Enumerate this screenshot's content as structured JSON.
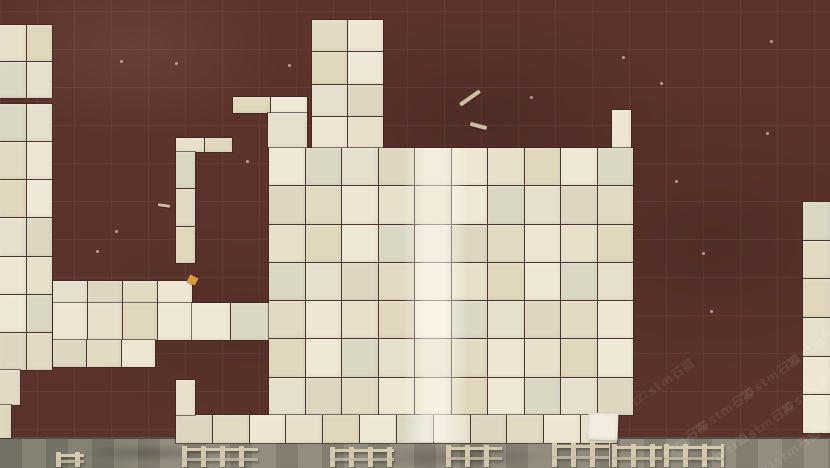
{
  "scene": {
    "description": "Top-down photo: cream marble tiles dry-laid in an irregular tetris-like pattern on a dark maroon screed floor; gray concrete walkway with small metal trestle stands along the bottom edge; diagonal watermarks in lower right",
    "colors": {
      "floor_maroon": "#5c332c",
      "tile_cream": "#e8e0cb",
      "tile_joint": "#4b372a",
      "concrete_gray": "#8d8779",
      "stand_metal": "#d8cfb5",
      "watermark": "#ffffff"
    },
    "watermark": {
      "text": "stm石猫",
      "opacity": 0.27,
      "angle_deg": -35,
      "positions": [
        [
          648,
          456
        ],
        [
          694,
          423
        ],
        [
          740,
          390
        ],
        [
          786,
          357
        ],
        [
          824,
          326
        ],
        [
          688,
          468
        ],
        [
          734,
          437
        ],
        [
          780,
          404
        ],
        [
          822,
          372
        ],
        [
          760,
          464
        ],
        [
          806,
          433
        ],
        [
          634,
          394
        ]
      ]
    },
    "tile_palette": [
      "#e8e0cb",
      "#eee6d2",
      "#e3dac4",
      "#ded6c0",
      "#e6dfcd",
      "#dbd7c5",
      "#efe8d6",
      "#e1d7bd"
    ],
    "tile_regions": [
      {
        "id": "left-top-block",
        "x": 0,
        "y": 25,
        "w": 52,
        "h": 73,
        "cols": 2,
        "rows": 2
      },
      {
        "id": "left-strip",
        "x": 0,
        "y": 104,
        "w": 52,
        "h": 266,
        "cols": 2,
        "rows": 7
      },
      {
        "id": "left-strip-step",
        "x": 0,
        "y": 370,
        "w": 20,
        "h": 35,
        "cols": 1,
        "rows": 1
      },
      {
        "id": "left-strip-foot",
        "x": 0,
        "y": 405,
        "w": 11,
        "h": 33,
        "cols": 1,
        "rows": 1
      },
      {
        "id": "mid-block-top",
        "x": 53,
        "y": 281,
        "w": 139,
        "h": 22,
        "cols": 4,
        "rows": 1
      },
      {
        "id": "mid-block-mid",
        "x": 53,
        "y": 303,
        "w": 139,
        "h": 37,
        "cols": 4,
        "rows": 1
      },
      {
        "id": "mid-block-ext",
        "x": 192,
        "y": 303,
        "w": 77,
        "h": 37,
        "cols": 2,
        "rows": 1
      },
      {
        "id": "mid-block-bottom",
        "x": 53,
        "y": 340,
        "w": 102,
        "h": 27,
        "cols": 3,
        "rows": 1
      },
      {
        "id": "hook-cap",
        "x": 176,
        "y": 138,
        "w": 56,
        "h": 14,
        "cols": 2,
        "rows": 1
      },
      {
        "id": "hook-stem",
        "x": 176,
        "y": 152,
        "w": 19,
        "h": 111,
        "cols": 1,
        "rows": 3
      },
      {
        "id": "top-column",
        "x": 312,
        "y": 20,
        "w": 71,
        "h": 128,
        "cols": 2,
        "rows": 4
      },
      {
        "id": "top-ledge",
        "x": 233,
        "y": 97,
        "w": 74,
        "h": 16,
        "cols": 2,
        "rows": 1
      },
      {
        "id": "top-ledge-leg",
        "x": 268,
        "y": 113,
        "w": 39,
        "h": 35,
        "cols": 1,
        "rows": 1
      },
      {
        "id": "blob-nub",
        "x": 612,
        "y": 110,
        "w": 19,
        "h": 38,
        "cols": 1,
        "rows": 1
      },
      {
        "id": "main-blob",
        "x": 269,
        "y": 148,
        "w": 364,
        "h": 267,
        "cols": 10,
        "rows": 7
      },
      {
        "id": "blob-bottom-row",
        "x": 176,
        "y": 415,
        "w": 441,
        "h": 28,
        "cols": 12,
        "rows": 1
      },
      {
        "id": "bottom-connector",
        "x": 176,
        "y": 380,
        "w": 19,
        "h": 35,
        "cols": 1,
        "rows": 1
      },
      {
        "id": "right-edge-column",
        "x": 803,
        "y": 202,
        "w": 27,
        "h": 231,
        "cols": 1,
        "rows": 6
      }
    ],
    "sheen_band": {
      "x": 402,
      "y": 148,
      "w": 66,
      "h": 294
    },
    "concrete": {
      "top_y": 437,
      "height": 31
    },
    "stands": [
      {
        "x": 56,
        "y": 452,
        "w": 28,
        "h": 15
      },
      {
        "x": 182,
        "y": 446,
        "w": 76,
        "h": 21
      },
      {
        "x": 330,
        "y": 447,
        "w": 64,
        "h": 20
      },
      {
        "x": 446,
        "y": 445,
        "w": 56,
        "h": 22
      },
      {
        "x": 552,
        "y": 443,
        "w": 58,
        "h": 24
      },
      {
        "x": 612,
        "y": 444,
        "w": 50,
        "h": 23
      },
      {
        "x": 664,
        "y": 444,
        "w": 60,
        "h": 23
      }
    ],
    "debris": {
      "sticks": [
        {
          "x": 458,
          "y": 96,
          "w": 24,
          "h": 4,
          "rot": -35
        },
        {
          "x": 470,
          "y": 124,
          "w": 17,
          "h": 4,
          "rot": 15
        },
        {
          "x": 158,
          "y": 204,
          "w": 12,
          "h": 3,
          "rot": 8
        }
      ],
      "chip": {
        "x": 188,
        "y": 276,
        "w": 9,
        "h": 8
      },
      "loose_tile": {
        "x": 588,
        "y": 413,
        "w": 30,
        "h": 27
      },
      "specks": [
        [
          120,
          60
        ],
        [
          246,
          160
        ],
        [
          288,
          64
        ],
        [
          175,
          62
        ],
        [
          530,
          96
        ],
        [
          622,
          56
        ],
        [
          660,
          82
        ],
        [
          675,
          180
        ],
        [
          702,
          252
        ],
        [
          710,
          310
        ],
        [
          766,
          132
        ],
        [
          770,
          40
        ],
        [
          96,
          250
        ],
        [
          115,
          230
        ]
      ]
    }
  }
}
